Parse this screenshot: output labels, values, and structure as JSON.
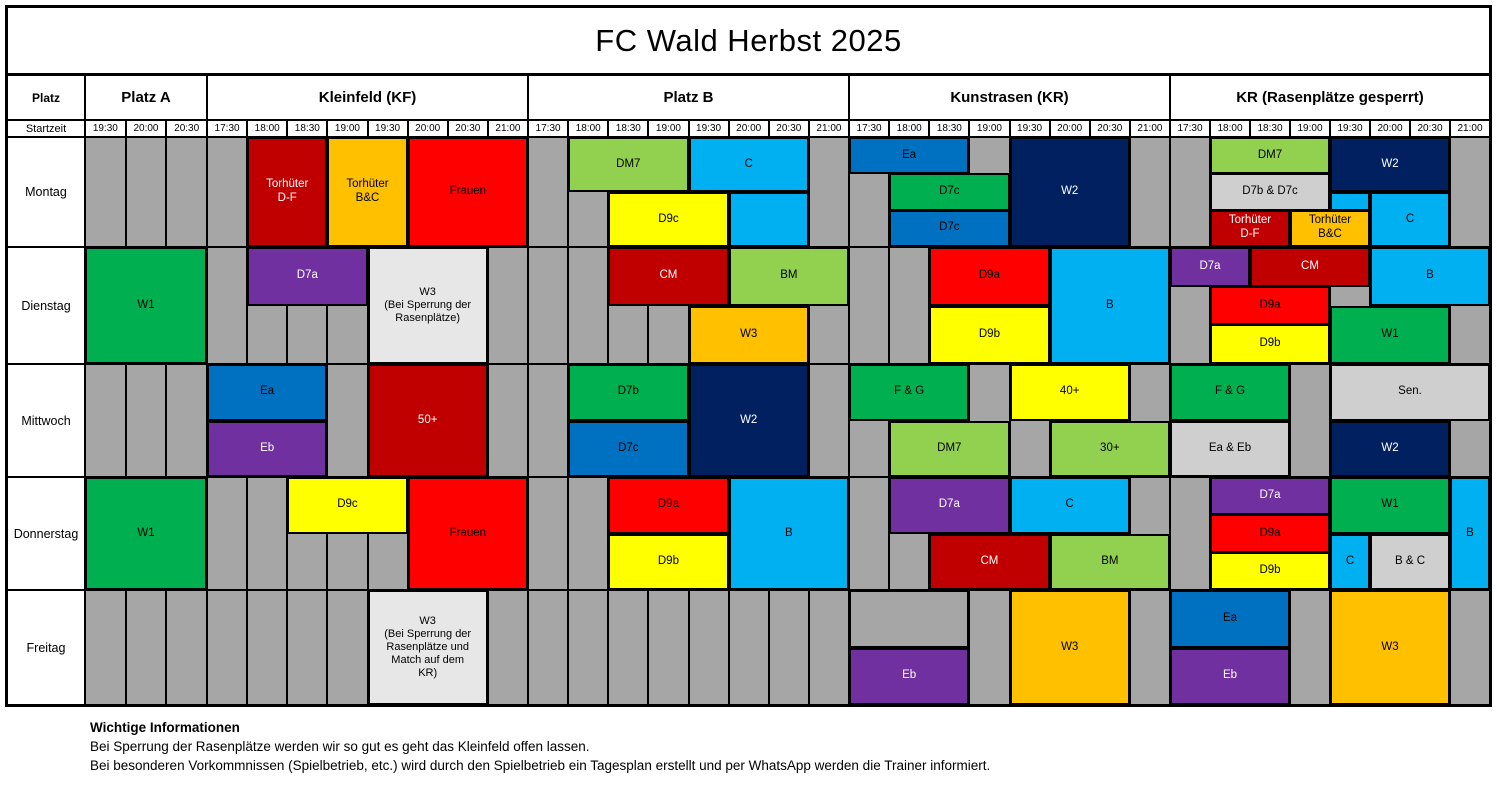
{
  "title": "FC Wald Herbst 2025",
  "header": {
    "platz": "Platz",
    "startzeit": "Startzeit"
  },
  "sections": [
    {
      "name": "Platz A",
      "times": [
        "19:30",
        "20:00",
        "20:30"
      ]
    },
    {
      "name": "Kleinfeld (KF)",
      "times": [
        "17:30",
        "18:00",
        "18:30",
        "19:00",
        "19:30",
        "20:00",
        "20:30",
        "21:00"
      ]
    },
    {
      "name": "Platz B",
      "times": [
        "17:30",
        "18:00",
        "18:30",
        "19:00",
        "19:30",
        "20:00",
        "20:30",
        "21:00"
      ]
    },
    {
      "name": "Kunstrasen (KR)",
      "times": [
        "17:30",
        "18:00",
        "18:30",
        "19:00",
        "19:30",
        "20:00",
        "20:30",
        "21:00"
      ]
    },
    {
      "name": "KR (Rasenplätze gesperrt)",
      "times": [
        "17:30",
        "18:00",
        "18:30",
        "19:00",
        "19:30",
        "20:00",
        "20:30",
        "21:00"
      ]
    }
  ],
  "days": [
    "Montag",
    "Dienstag",
    "Mittwoch",
    "Donnerstag",
    "Freitag"
  ],
  "colors": {
    "slot": "#a6a6a6",
    "darkred": "#c00000",
    "red": "#fe0000",
    "amber": "#ffc000",
    "yellow": "#ffff00",
    "green": "#00b050",
    "lightgreen": "#92d050",
    "cyan": "#00b0f0",
    "blue": "#0070c0",
    "purple": "#7030a0",
    "navy": "#002060",
    "lightgray": "#cfcfcf",
    "paler": "#e7e7e7"
  },
  "blocks": [
    {
      "day": "Montag",
      "sec": "Kleinfeld (KF)",
      "start": "18:00",
      "span": 2,
      "top": 0,
      "h": 1,
      "color": "darkred",
      "label": "Torhüter\nD-F",
      "white": true
    },
    {
      "day": "Montag",
      "sec": "Kleinfeld (KF)",
      "start": "19:00",
      "span": 2,
      "top": 0,
      "h": 1,
      "color": "amber",
      "label": "Torhüter\nB&C"
    },
    {
      "day": "Montag",
      "sec": "Kleinfeld (KF)",
      "start": "20:00",
      "span": 3,
      "top": 0,
      "h": 1,
      "color": "red",
      "label": "Frauen"
    },
    {
      "day": "Montag",
      "sec": "Platz B",
      "start": "18:00",
      "span": 3,
      "top": 0,
      "h": 0.5,
      "color": "lightgreen",
      "label": "DM7"
    },
    {
      "day": "Montag",
      "sec": "Platz B",
      "start": "18:30",
      "span": 3,
      "top": 0.5,
      "h": 0.5,
      "color": "yellow",
      "label": "D9c"
    },
    {
      "day": "Montag",
      "sec": "Platz B",
      "start": "20:00",
      "span": 2,
      "top": 0.5,
      "h": 0.5,
      "color": "cyan",
      "label": ""
    },
    {
      "day": "Montag",
      "sec": "Platz B",
      "start": "19:30",
      "span": 3,
      "top": 0,
      "h": 0.5,
      "color": "cyan",
      "label": "C"
    },
    {
      "day": "Montag",
      "sec": "Kunstrasen (KR)",
      "start": "17:30",
      "span": 3,
      "top": 0,
      "h": 0.34,
      "color": "blue",
      "label": "Ea"
    },
    {
      "day": "Montag",
      "sec": "Kunstrasen (KR)",
      "start": "18:00",
      "span": 3,
      "top": 0.33,
      "h": 0.34,
      "color": "green",
      "label": "D7c"
    },
    {
      "day": "Montag",
      "sec": "Kunstrasen (KR)",
      "start": "18:00",
      "span": 3,
      "top": 0.66,
      "h": 0.34,
      "color": "blue",
      "label": "D7c"
    },
    {
      "day": "Montag",
      "sec": "Kunstrasen (KR)",
      "start": "19:30",
      "span": 3,
      "top": 0,
      "h": 1,
      "color": "navy",
      "label": "W2",
      "white": true
    },
    {
      "day": "Montag",
      "sec": "KR (Rasenplätze gesperrt)",
      "start": "18:00",
      "span": 3,
      "top": 0,
      "h": 0.34,
      "color": "lightgreen",
      "label": "DM7"
    },
    {
      "day": "Montag",
      "sec": "KR (Rasenplätze gesperrt)",
      "start": "18:00",
      "span": 3,
      "top": 0.33,
      "h": 0.34,
      "color": "lightgray",
      "label": "D7b & D7c"
    },
    {
      "day": "Montag",
      "sec": "KR (Rasenplätze gesperrt)",
      "start": "18:00",
      "span": 2,
      "top": 0.66,
      "h": 0.34,
      "color": "darkred",
      "label": "Torhüter\nD-F",
      "white": true
    },
    {
      "day": "Montag",
      "sec": "KR (Rasenplätze gesperrt)",
      "start": "19:00",
      "span": 2,
      "top": 0.66,
      "h": 0.34,
      "color": "amber",
      "label": "Torhüter\nB&C"
    },
    {
      "day": "Montag",
      "sec": "KR (Rasenplätze gesperrt)",
      "start": "19:30",
      "span": 1,
      "top": 0.5,
      "h": 0.17,
      "color": "cyan",
      "label": ""
    },
    {
      "day": "Montag",
      "sec": "KR (Rasenplätze gesperrt)",
      "start": "19:30",
      "span": 3,
      "top": 0,
      "h": 0.5,
      "color": "navy",
      "label": "W2",
      "white": true
    },
    {
      "day": "Montag",
      "sec": "KR (Rasenplätze gesperrt)",
      "start": "20:00",
      "span": 2,
      "top": 0.5,
      "h": 0.5,
      "color": "cyan",
      "label": "C"
    },
    {
      "day": "Dienstag",
      "sec": "Platz A",
      "start": "19:30",
      "span": 3,
      "top": 0,
      "h": 1,
      "color": "green",
      "label": "W1"
    },
    {
      "day": "Dienstag",
      "sec": "Kleinfeld (KF)",
      "start": "18:00",
      "span": 3,
      "top": 0,
      "h": 0.5,
      "color": "purple",
      "label": "D7a",
      "white": true
    },
    {
      "day": "Dienstag",
      "sec": "Kleinfeld (KF)",
      "start": "19:30",
      "span": 3,
      "top": 0,
      "h": 1,
      "color": "paler",
      "label": "W3\n(Bei Sperrung der\nRasenplätze)"
    },
    {
      "day": "Dienstag",
      "sec": "Platz B",
      "start": "18:30",
      "span": 3,
      "top": 0,
      "h": 0.5,
      "color": "darkred",
      "label": "CM",
      "white": true
    },
    {
      "day": "Dienstag",
      "sec": "Platz B",
      "start": "20:00",
      "span": 3,
      "top": 0,
      "h": 0.5,
      "color": "lightgreen",
      "label": "BM"
    },
    {
      "day": "Dienstag",
      "sec": "Platz B",
      "start": "19:30",
      "span": 3,
      "top": 0.5,
      "h": 0.5,
      "color": "amber",
      "label": "W3"
    },
    {
      "day": "Dienstag",
      "sec": "Kunstrasen (KR)",
      "start": "18:30",
      "span": 3,
      "top": 0,
      "h": 0.5,
      "color": "red",
      "label": "D9a"
    },
    {
      "day": "Dienstag",
      "sec": "Kunstrasen (KR)",
      "start": "18:30",
      "span": 3,
      "top": 0.5,
      "h": 0.5,
      "color": "yellow",
      "label": "D9b"
    },
    {
      "day": "Dienstag",
      "sec": "Kunstrasen (KR)",
      "start": "20:00",
      "span": 3,
      "top": 0,
      "h": 1,
      "color": "cyan",
      "label": "B"
    },
    {
      "day": "Dienstag",
      "sec": "KR (Rasenplätze gesperrt)",
      "start": "17:30",
      "span": 2,
      "top": 0,
      "h": 0.34,
      "color": "purple",
      "label": "D7a",
      "white": true
    },
    {
      "day": "Dienstag",
      "sec": "KR (Rasenplätze gesperrt)",
      "start": "18:30",
      "span": 3,
      "top": 0,
      "h": 0.34,
      "color": "darkred",
      "label": "CM",
      "white": true
    },
    {
      "day": "Dienstag",
      "sec": "KR (Rasenplätze gesperrt)",
      "start": "18:00",
      "span": 3,
      "top": 0.33,
      "h": 0.34,
      "color": "red",
      "label": "D9a"
    },
    {
      "day": "Dienstag",
      "sec": "KR (Rasenplätze gesperrt)",
      "start": "18:00",
      "span": 3,
      "top": 0.66,
      "h": 0.34,
      "color": "yellow",
      "label": "D9b"
    },
    {
      "day": "Dienstag",
      "sec": "KR (Rasenplätze gesperrt)",
      "start": "20:00",
      "span": 3,
      "top": 0,
      "h": 0.5,
      "color": "cyan",
      "label": "B"
    },
    {
      "day": "Dienstag",
      "sec": "KR (Rasenplätze gesperrt)",
      "start": "19:30",
      "span": 3,
      "top": 0.5,
      "h": 0.5,
      "color": "green",
      "label": "W1"
    },
    {
      "day": "Mittwoch",
      "sec": "Kleinfeld (KF)",
      "start": "17:30",
      "span": 3,
      "top": 0,
      "h": 0.5,
      "color": "blue",
      "label": "Ea"
    },
    {
      "day": "Mittwoch",
      "sec": "Kleinfeld (KF)",
      "start": "17:30",
      "span": 3,
      "top": 0.5,
      "h": 0.5,
      "color": "purple",
      "label": "Eb",
      "white": true
    },
    {
      "day": "Mittwoch",
      "sec": "Kleinfeld (KF)",
      "start": "19:30",
      "span": 3,
      "top": 0,
      "h": 1,
      "color": "darkred",
      "label": "50+",
      "white": true
    },
    {
      "day": "Mittwoch",
      "sec": "Platz B",
      "start": "18:00",
      "span": 3,
      "top": 0,
      "h": 0.5,
      "color": "green",
      "label": "D7b"
    },
    {
      "day": "Mittwoch",
      "sec": "Platz B",
      "start": "18:00",
      "span": 3,
      "top": 0.5,
      "h": 0.5,
      "color": "blue",
      "label": "D7c"
    },
    {
      "day": "Mittwoch",
      "sec": "Platz B",
      "start": "19:30",
      "span": 3,
      "top": 0,
      "h": 1,
      "color": "navy",
      "label": "W2",
      "white": true
    },
    {
      "day": "Mittwoch",
      "sec": "Kunstrasen (KR)",
      "start": "17:30",
      "span": 3,
      "top": 0,
      "h": 0.5,
      "color": "green",
      "label": "F & G"
    },
    {
      "day": "Mittwoch",
      "sec": "Kunstrasen (KR)",
      "start": "19:30",
      "span": 3,
      "top": 0,
      "h": 0.5,
      "color": "yellow",
      "label": "40+"
    },
    {
      "day": "Mittwoch",
      "sec": "Kunstrasen (KR)",
      "start": "18:00",
      "span": 3,
      "top": 0.5,
      "h": 0.5,
      "color": "lightgreen",
      "label": "DM7"
    },
    {
      "day": "Mittwoch",
      "sec": "Kunstrasen (KR)",
      "start": "20:00",
      "span": 3,
      "top": 0.5,
      "h": 0.5,
      "color": "lightgreen",
      "label": "30+"
    },
    {
      "day": "Mittwoch",
      "sec": "KR (Rasenplätze gesperrt)",
      "start": "17:30",
      "span": 3,
      "top": 0,
      "h": 0.5,
      "color": "green",
      "label": "F & G"
    },
    {
      "day": "Mittwoch",
      "sec": "KR (Rasenplätze gesperrt)",
      "start": "17:30",
      "span": 3,
      "top": 0.5,
      "h": 0.5,
      "color": "lightgray",
      "label": "Ea & Eb"
    },
    {
      "day": "Mittwoch",
      "sec": "KR (Rasenplätze gesperrt)",
      "start": "19:30",
      "span": 4,
      "top": 0,
      "h": 0.5,
      "color": "lightgray",
      "label": "Sen."
    },
    {
      "day": "Mittwoch",
      "sec": "KR (Rasenplätze gesperrt)",
      "start": "19:30",
      "span": 3,
      "top": 0.5,
      "h": 0.5,
      "color": "navy",
      "label": "W2",
      "white": true
    },
    {
      "day": "Donnerstag",
      "sec": "Platz A",
      "start": "19:30",
      "span": 3,
      "top": 0,
      "h": 1,
      "color": "green",
      "label": "W1"
    },
    {
      "day": "Donnerstag",
      "sec": "Kleinfeld (KF)",
      "start": "18:30",
      "span": 3,
      "top": 0,
      "h": 0.5,
      "color": "yellow",
      "label": "D9c"
    },
    {
      "day": "Donnerstag",
      "sec": "Kleinfeld (KF)",
      "start": "20:00",
      "span": 3,
      "top": 0,
      "h": 1,
      "color": "red",
      "label": "Frauen"
    },
    {
      "day": "Donnerstag",
      "sec": "Platz B",
      "start": "18:30",
      "span": 3,
      "top": 0,
      "h": 0.5,
      "color": "red",
      "label": "D9a"
    },
    {
      "day": "Donnerstag",
      "sec": "Platz B",
      "start": "18:30",
      "span": 3,
      "top": 0.5,
      "h": 0.5,
      "color": "yellow",
      "label": "D9b"
    },
    {
      "day": "Donnerstag",
      "sec": "Platz B",
      "start": "20:00",
      "span": 3,
      "top": 0,
      "h": 1,
      "color": "cyan",
      "label": "B"
    },
    {
      "day": "Donnerstag",
      "sec": "Kunstrasen (KR)",
      "start": "18:00",
      "span": 3,
      "top": 0,
      "h": 0.5,
      "color": "purple",
      "label": "D7a",
      "white": true
    },
    {
      "day": "Donnerstag",
      "sec": "Kunstrasen (KR)",
      "start": "19:30",
      "span": 3,
      "top": 0,
      "h": 0.5,
      "color": "cyan",
      "label": "C"
    },
    {
      "day": "Donnerstag",
      "sec": "Kunstrasen (KR)",
      "start": "18:30",
      "span": 3,
      "top": 0.5,
      "h": 0.5,
      "color": "darkred",
      "label": "CM",
      "white": true
    },
    {
      "day": "Donnerstag",
      "sec": "Kunstrasen (KR)",
      "start": "20:00",
      "span": 3,
      "top": 0.5,
      "h": 0.5,
      "color": "lightgreen",
      "label": "BM"
    },
    {
      "day": "Donnerstag",
      "sec": "KR (Rasenplätze gesperrt)",
      "start": "18:00",
      "span": 3,
      "top": 0,
      "h": 0.34,
      "color": "purple",
      "label": "D7a",
      "white": true
    },
    {
      "day": "Donnerstag",
      "sec": "KR (Rasenplätze gesperrt)",
      "start": "18:00",
      "span": 3,
      "top": 0.33,
      "h": 0.34,
      "color": "red",
      "label": "D9a"
    },
    {
      "day": "Donnerstag",
      "sec": "KR (Rasenplätze gesperrt)",
      "start": "18:00",
      "span": 3,
      "top": 0.66,
      "h": 0.34,
      "color": "yellow",
      "label": "D9b"
    },
    {
      "day": "Donnerstag",
      "sec": "KR (Rasenplätze gesperrt)",
      "start": "19:30",
      "span": 3,
      "top": 0,
      "h": 0.5,
      "color": "green",
      "label": "W1"
    },
    {
      "day": "Donnerstag",
      "sec": "KR (Rasenplätze gesperrt)",
      "start": "19:30",
      "span": 1,
      "top": 0.5,
      "h": 0.5,
      "color": "cyan",
      "label": "C"
    },
    {
      "day": "Donnerstag",
      "sec": "KR (Rasenplätze gesperrt)",
      "start": "20:00",
      "span": 2,
      "top": 0.5,
      "h": 0.5,
      "color": "lightgray",
      "label": "B & C"
    },
    {
      "day": "Donnerstag",
      "sec": "KR (Rasenplätze gesperrt)",
      "start": "21:00",
      "span": 1,
      "top": 0,
      "h": 1,
      "color": "cyan",
      "label": "B"
    },
    {
      "day": "Freitag",
      "sec": "Kleinfeld (KF)",
      "start": "19:30",
      "span": 3,
      "top": 0,
      "h": 1,
      "color": "paler",
      "label": "W3\n(Bei Sperrung der\nRasenplätze und\nMatch auf dem\nKR)"
    },
    {
      "day": "Freitag",
      "sec": "Kunstrasen (KR)",
      "start": "17:30",
      "span": 3,
      "top": 0,
      "h": 0.5,
      "color": "slot",
      "label": ""
    },
    {
      "day": "Freitag",
      "sec": "Kunstrasen (KR)",
      "start": "17:30",
      "span": 3,
      "top": 0.5,
      "h": 0.5,
      "color": "purple",
      "label": "Eb",
      "white": true
    },
    {
      "day": "Freitag",
      "sec": "Kunstrasen (KR)",
      "start": "19:30",
      "span": 3,
      "top": 0,
      "h": 1,
      "color": "amber",
      "label": "W3"
    },
    {
      "day": "Freitag",
      "sec": "KR (Rasenplätze gesperrt)",
      "start": "17:30",
      "span": 3,
      "top": 0,
      "h": 0.5,
      "color": "blue",
      "label": "Ea"
    },
    {
      "day": "Freitag",
      "sec": "KR (Rasenplätze gesperrt)",
      "start": "17:30",
      "span": 3,
      "top": 0.5,
      "h": 0.5,
      "color": "purple",
      "label": "Eb",
      "white": true
    },
    {
      "day": "Freitag",
      "sec": "KR (Rasenplätze gesperrt)",
      "start": "19:30",
      "span": 3,
      "top": 0,
      "h": 1,
      "color": "amber",
      "label": "W3"
    }
  ],
  "footer": {
    "heading": "Wichtige Informationen",
    "lines": [
      "Bei Sperrung der Rasenplätze werden wir so gut es geht das Kleinfeld offen lassen.",
      "Bei besonderen Vorkommnissen (Spielbetrieb, etc.) wird durch den Spielbetrieb ein Tagesplan erstellt und per WhatsApp werden die Trainer informiert."
    ]
  }
}
